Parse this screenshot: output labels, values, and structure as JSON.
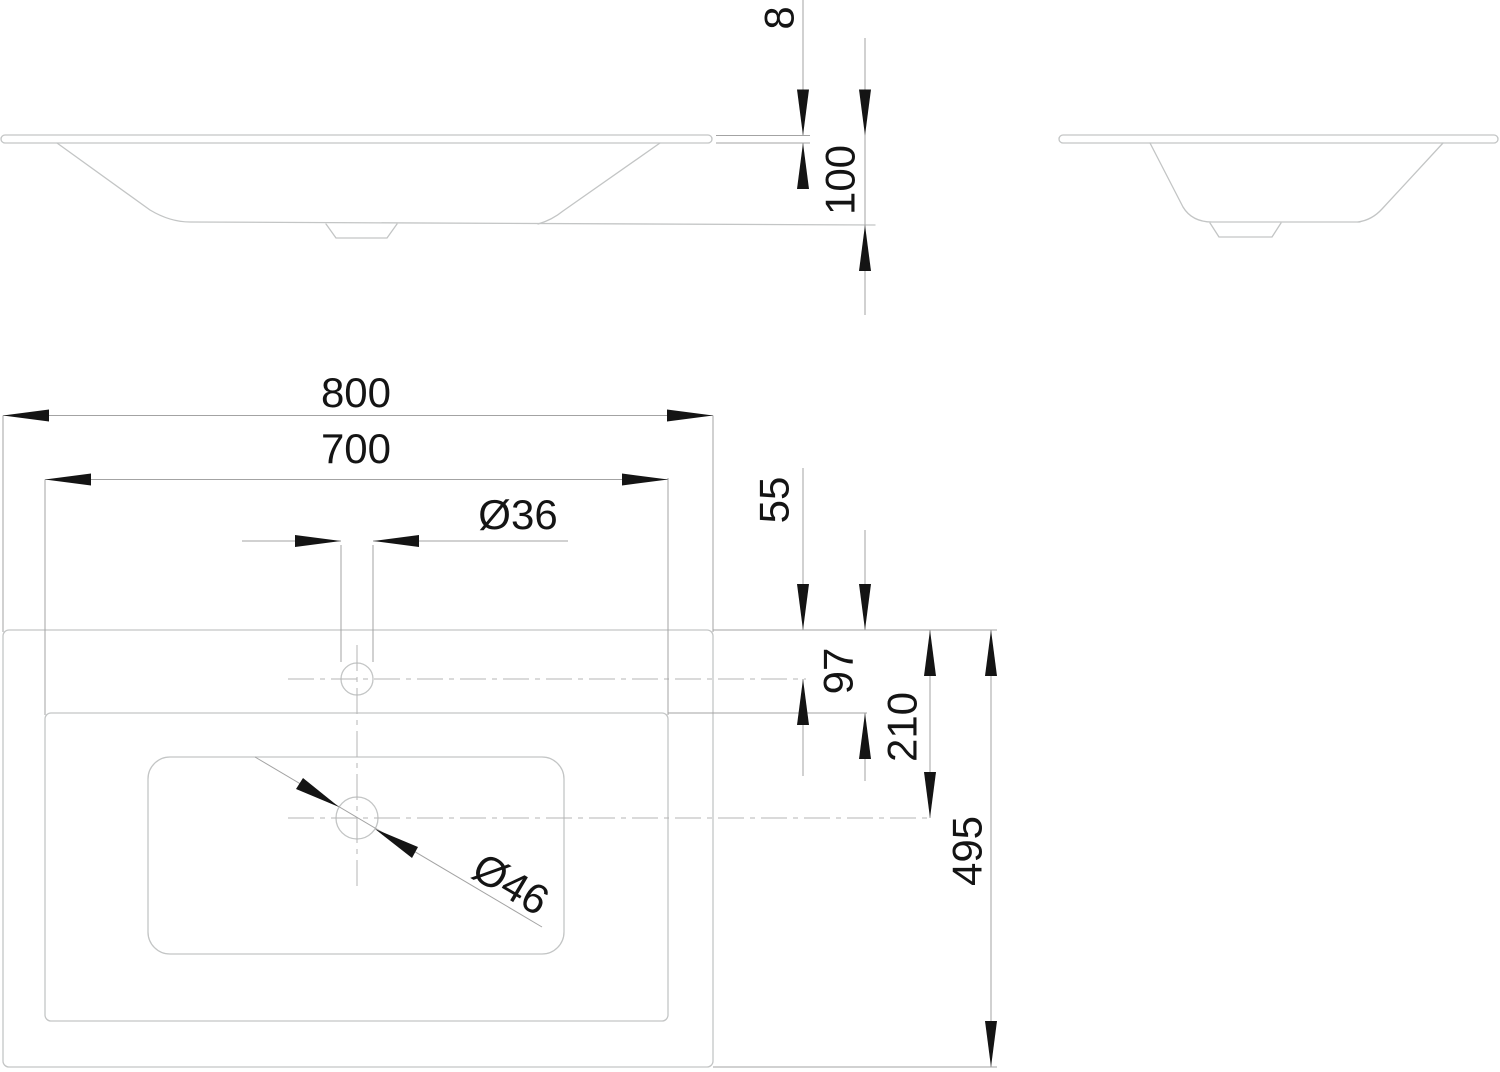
{
  "drawing_labels": {
    "rim_thickness": "8",
    "bowl_depth": "100",
    "overall_width": "800",
    "bowl_width": "700",
    "tap_hole_diameter": "Ø36",
    "front_edge_to_tap_hole": "55",
    "front_edge_to_bowl": "97",
    "front_edge_to_drain": "210",
    "overall_depth": "495",
    "drain_diameter": "Ø46"
  }
}
